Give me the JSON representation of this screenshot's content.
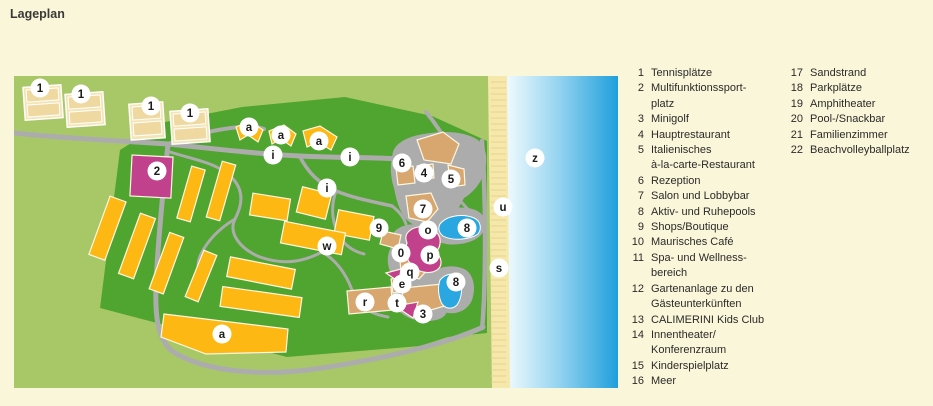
{
  "title": "Lageplan",
  "legend": {
    "column_a": [
      {
        "num": "1",
        "label": "Tennisplätze"
      },
      {
        "num": "2",
        "label": "Multifunktionssport-\nplatz"
      },
      {
        "num": "3",
        "label": "Minigolf"
      },
      {
        "num": "4",
        "label": "Hauptrestaurant"
      },
      {
        "num": "5",
        "label": "Italienisches\nà-la-carte-Restaurant"
      },
      {
        "num": "6",
        "label": "Rezeption"
      },
      {
        "num": "7",
        "label": "Salon und Lobbybar"
      },
      {
        "num": "8",
        "label": "Aktiv- und Ruhepools"
      },
      {
        "num": "9",
        "label": "Shops/Boutique"
      },
      {
        "num": "10",
        "label": "Maurisches Café"
      },
      {
        "num": "11",
        "label": "Spa- und Wellness-\nbereich"
      },
      {
        "num": "12",
        "label": "Gartenanlage zu den\nGästeunterkünften"
      },
      {
        "num": "13",
        "label": "CALIMERINI Kids Club"
      },
      {
        "num": "14",
        "label": "Innentheater/\nKonferenzraum"
      },
      {
        "num": "15",
        "label": "Kinderspielplatz"
      },
      {
        "num": "16",
        "label": "Meer"
      }
    ],
    "column_b": [
      {
        "num": "17",
        "label": "Sandstrand"
      },
      {
        "num": "18",
        "label": "Parkplätze"
      },
      {
        "num": "19",
        "label": "Amphitheater"
      },
      {
        "num": "20",
        "label": "Pool-/Snackbar"
      },
      {
        "num": "21",
        "label": "Familienzimmer"
      },
      {
        "num": "22",
        "label": "Beachvolleyballplatz"
      }
    ]
  },
  "map": {
    "markers": [
      {
        "glyph": "1",
        "x": 40,
        "y": 88
      },
      {
        "glyph": "1",
        "x": 81,
        "y": 94
      },
      {
        "glyph": "1",
        "x": 151,
        "y": 106
      },
      {
        "glyph": "1",
        "x": 190,
        "y": 113
      },
      {
        "glyph": "2",
        "x": 157,
        "y": 171
      },
      {
        "glyph": "a",
        "x": 249,
        "y": 127
      },
      {
        "glyph": "a",
        "x": 281,
        "y": 135
      },
      {
        "glyph": "a",
        "x": 319,
        "y": 141
      },
      {
        "glyph": "i",
        "x": 273,
        "y": 155
      },
      {
        "glyph": "i",
        "x": 350,
        "y": 157
      },
      {
        "glyph": "i",
        "x": 327,
        "y": 188
      },
      {
        "glyph": "6",
        "x": 402,
        "y": 163
      },
      {
        "glyph": "4",
        "x": 424,
        "y": 173
      },
      {
        "glyph": "5",
        "x": 451,
        "y": 179
      },
      {
        "glyph": "7",
        "x": 423,
        "y": 209
      },
      {
        "glyph": "9",
        "x": 379,
        "y": 228
      },
      {
        "glyph": "8",
        "x": 467,
        "y": 228
      },
      {
        "glyph": "o",
        "x": 428,
        "y": 230
      },
      {
        "glyph": "w",
        "x": 327,
        "y": 246
      },
      {
        "glyph": "0",
        "x": 401,
        "y": 253
      },
      {
        "glyph": "p",
        "x": 430,
        "y": 255
      },
      {
        "glyph": "q",
        "x": 410,
        "y": 272
      },
      {
        "glyph": "e",
        "x": 402,
        "y": 284
      },
      {
        "glyph": "8",
        "x": 456,
        "y": 282
      },
      {
        "glyph": "r",
        "x": 365,
        "y": 302
      },
      {
        "glyph": "t",
        "x": 397,
        "y": 303
      },
      {
        "glyph": "3",
        "x": 423,
        "y": 314
      },
      {
        "glyph": "a",
        "x": 222,
        "y": 334
      },
      {
        "glyph": "z",
        "x": 535,
        "y": 158
      },
      {
        "glyph": "u",
        "x": 503,
        "y": 207
      },
      {
        "glyph": "s",
        "x": 499,
        "y": 268
      }
    ]
  },
  "colors": {
    "page_background": "#FAF6D9",
    "light_green": "#A8C868",
    "dark_green": "#4FA52F",
    "road_gray": "#ACACAC",
    "building_gold": "#FDB813",
    "building_tan": "#D7A76F",
    "sport_magenta": "#C2418D",
    "pool_blue": "#2AA7E0",
    "sand": "#F6E8AB",
    "sand_line": "#E6D28E",
    "sea_deep": "#1F9FDB",
    "sea_light": "#F2FBFE",
    "tennis_cream": "#F4E5B6",
    "tennis_court": "#EFD9A0",
    "marker_bg": "#FFFFFF",
    "text_ink": "#2B2A29"
  }
}
